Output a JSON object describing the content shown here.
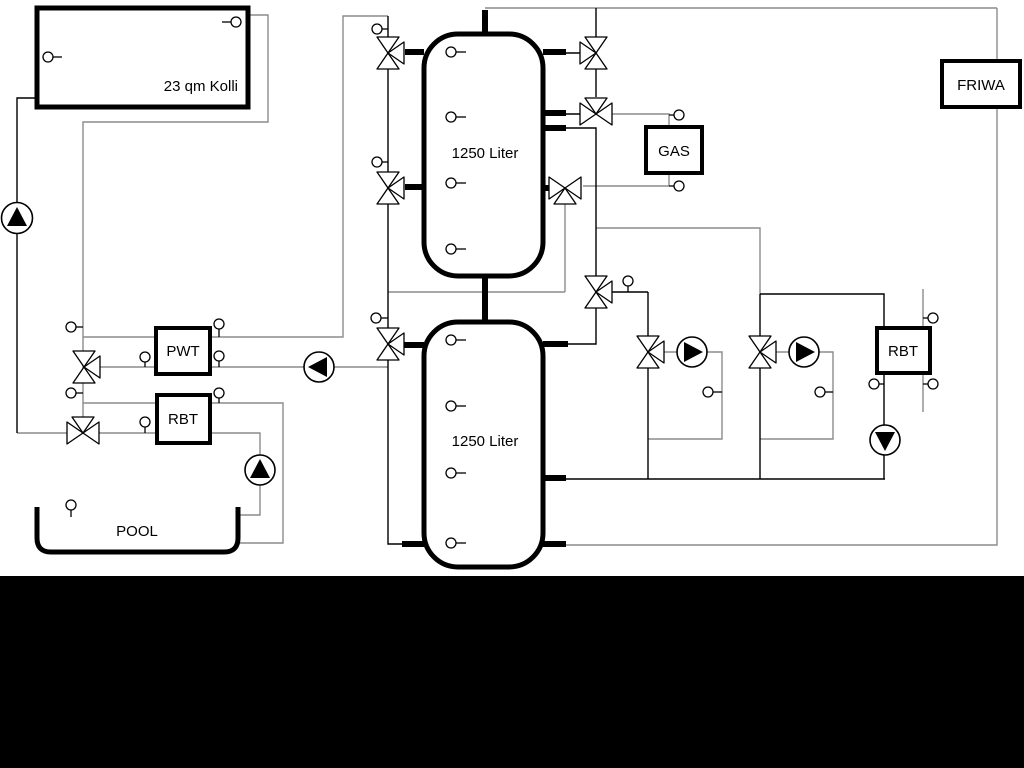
{
  "diagram": {
    "collector": {
      "label": "23 qm Kolli"
    },
    "tank_top": {
      "label": "1250 Liter"
    },
    "tank_bottom": {
      "label": "1250 Liter"
    },
    "gas": {
      "label": "GAS"
    },
    "friwa": {
      "label": "FRIWA"
    },
    "pwt": {
      "label": "PWT"
    },
    "rbt_left": {
      "label": "RBT"
    },
    "rbt_right": {
      "label": "RBT"
    },
    "pool": {
      "label": "POOL"
    }
  },
  "colors": {
    "background": "#ffffff",
    "pipe_gray": "#8b8b8b",
    "pipe_black": "#000000",
    "component_border": "#000000",
    "bottom_bar": "#000000"
  }
}
